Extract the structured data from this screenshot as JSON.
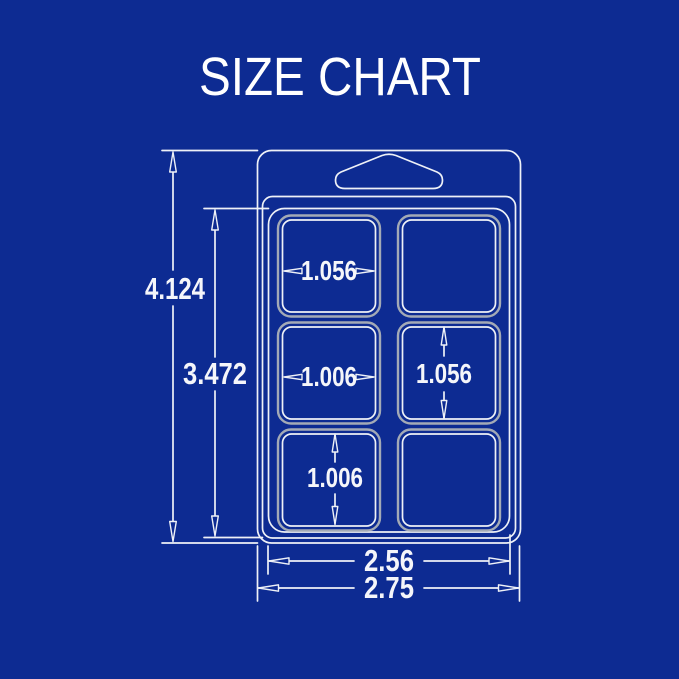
{
  "title": "SIZE CHART",
  "colors": {
    "background": "#0d2b92",
    "line": "#eef1f7",
    "cell_outline": "#a3aab6",
    "text": "#f5f6fa"
  },
  "dimensions": {
    "overall_height": "4.124",
    "body_height": "3.472",
    "inner_width": "2.56",
    "overall_width": "2.75",
    "cell_width_top": "1.056",
    "cell_width_middle": "1.006",
    "cell_height_middle": "1.056",
    "cell_height_bottom": "1.006"
  }
}
